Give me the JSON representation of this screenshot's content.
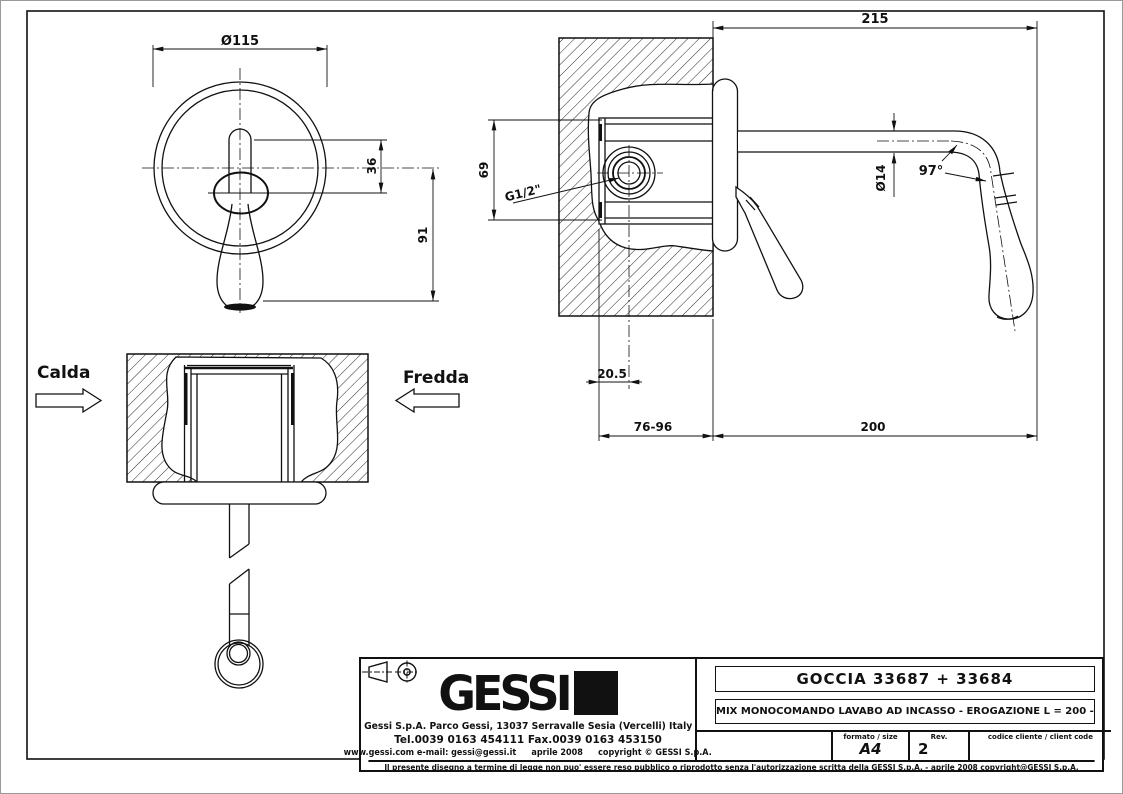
{
  "drawing": {
    "flow_labels": {
      "hot": "Calda",
      "cold": "Fredda"
    },
    "dimensions": {
      "front_diameter": "Ø115",
      "front_handle_offset": "36",
      "front_handle_length": "91",
      "overall_projection": "215",
      "body_height": "69",
      "inlet_thread": "G1/2\"",
      "spout_tube_diameter": "Ø14",
      "spout_bend_angle": "97°",
      "inlet_center_depth": "20.5",
      "wall_embed_range": "76-96",
      "spout_reach": "200"
    }
  },
  "title_block": {
    "logo_text": "GESSI",
    "address": "Gessi S.p.A. Parco Gessi, 13037 Serravalle Sesia (Vercelli) Italy",
    "phone": "Tel.0039 0163 454111 Fax.0039 0163 453150",
    "web_left": "www.gessi.com e-mail: gessi@gessi.it",
    "web_date": "aprile 2008",
    "web_copyright": "copyright © GESSI S.p.A.",
    "product_title": "GOCCIA 33687 + 33684",
    "product_description": "MIX MONOCOMANDO LAVABO AD INCASSO - EROGAZIONE L = 200 -",
    "format_label": "formato / size",
    "format_value": "A4",
    "rev_label": "Rev.",
    "rev_value": "2",
    "client_code_label": "codice cliente / client code",
    "disclaimer": "Il presente disegno a termine di legge non puo' essere reso pubblico o riprodotto senza l'autorizzazione scritta della GESSI S.p.A. - aprile 2008 copyright@GESSI S.p.A."
  }
}
